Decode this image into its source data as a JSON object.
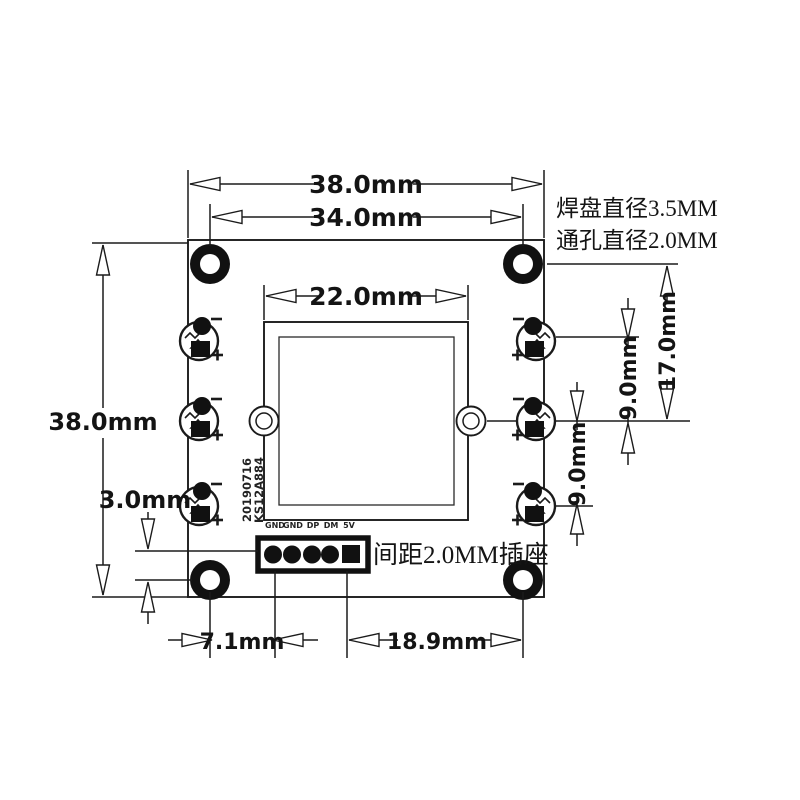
{
  "notes": {
    "pad_diameter": "焊盘直径3.5MM",
    "hole_diameter": "通孔直径2.0MM",
    "socket_pitch": "间距2.0MM插座",
    "silkscreen_date": "20190716",
    "silkscreen_model": "KS12A884"
  },
  "pin_labels": [
    "GND",
    "GND",
    "DP",
    "DM",
    "5V"
  ],
  "dimensions": {
    "board_width_top": "38.0mm",
    "mount_hole_spacing": "34.0mm",
    "sensor_width": "22.0mm",
    "board_height_left": "38.0mm",
    "connector_to_hole": "3.0mm",
    "hole_to_pin": "7.1mm",
    "pin_to_hole": "18.9mm",
    "hole_to_center": "17.0mm",
    "led_pitch_upper": "9.0mm",
    "led_pitch_lower": "9.0mm"
  },
  "colors": {
    "line": "#1b1b1b",
    "fill_dark": "#111111",
    "background": "#ffffff"
  }
}
